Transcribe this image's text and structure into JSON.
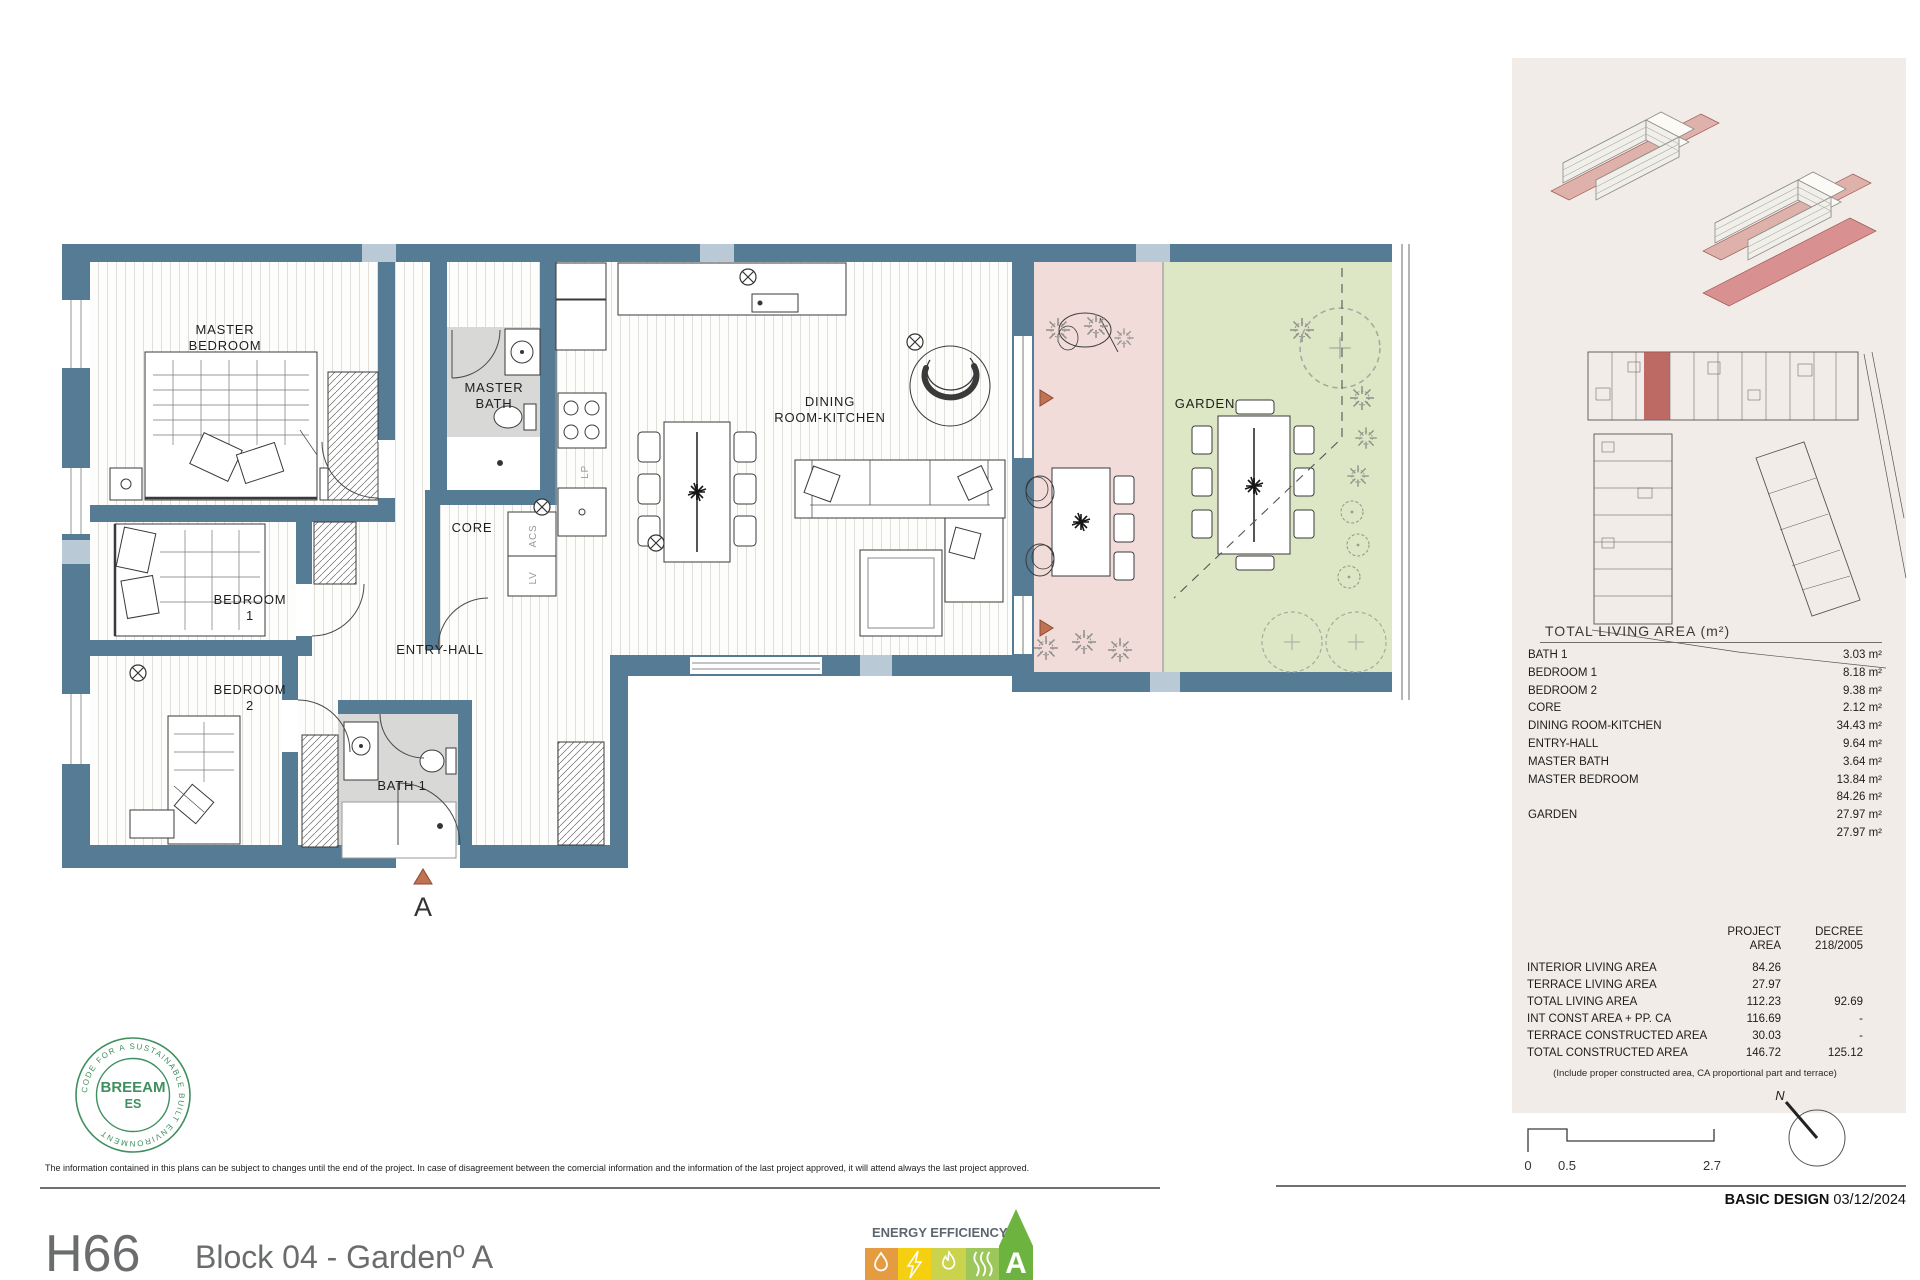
{
  "colors": {
    "wall": "#567b94",
    "wall_light": "#b9cad6",
    "terrace_floor": "#f2dcda",
    "garden_floor": "#dde7c5",
    "bath_floor": "#d8d8d6",
    "panel_background": "#f2ece8",
    "site_highlight_red": "#b4544d",
    "breeam_green": "#3f8f5f",
    "marker_terracotta": "#bf7350",
    "energy_orange": "#e59b40",
    "energy_yellow": "#f5d011",
    "energy_yellow_green": "#cbd34c",
    "energy_light_green": "#9dc65b",
    "energy_a_green": "#6db33f",
    "footer_gray": "#6a6c6e"
  },
  "plan": {
    "labels": {
      "master_bedroom_l1": "MASTER",
      "master_bedroom_l2": "BEDROOM",
      "master_bath_l1": "MASTER",
      "master_bath_l2": "BATH",
      "dining_l1": "DINING",
      "dining_l2": "ROOM-KITCHEN",
      "bedroom1_l1": "BEDROOM",
      "bedroom1_l2": "1",
      "bedroom2_l1": "BEDROOM",
      "bedroom2_l2": "2",
      "entry_hall": "ENTRY-HALL",
      "core": "CORE",
      "bath1": "BATH 1",
      "garden": "GARDEN",
      "lp": "LP",
      "acs": "ACS",
      "lv": "LV",
      "section_marker": "A"
    }
  },
  "panel": {
    "area_table": {
      "title": "TOTAL LIVING AREA (m²)",
      "rows": [
        {
          "label": "BATH 1",
          "value": "3.03 m²"
        },
        {
          "label": "BEDROOM 1",
          "value": "8.18 m²"
        },
        {
          "label": "BEDROOM 2",
          "value": "9.38 m²"
        },
        {
          "label": "CORE",
          "value": "2.12 m²"
        },
        {
          "label": "DINING ROOM-KITCHEN",
          "value": "34.43 m²"
        },
        {
          "label": "ENTRY-HALL",
          "value": "9.64 m²"
        },
        {
          "label": "MASTER BATH",
          "value": "3.64 m²"
        },
        {
          "label": "MASTER BEDROOM",
          "value": "13.84 m²"
        },
        {
          "label": "",
          "value": "84.26 m²"
        },
        {
          "label": "GARDEN",
          "value": "27.97 m²"
        },
        {
          "label": "",
          "value": "27.97 m²"
        }
      ]
    },
    "summary_table": {
      "header_col1_l1": "PROJECT",
      "header_col1_l2": "AREA",
      "header_col2_l1": "DECREE",
      "header_col2_l2": "218/2005",
      "rows": [
        {
          "label": "INTERIOR LIVING AREA",
          "project": "84.26",
          "decree": ""
        },
        {
          "label": "TERRACE LIVING AREA",
          "project": "27.97",
          "decree": ""
        },
        {
          "label": "TOTAL LIVING AREA",
          "project": "112.23",
          "decree": "92.69"
        },
        {
          "label": "INT CONST AREA + PP. CA",
          "project": "116.69",
          "decree": "-"
        },
        {
          "label": "TERRACE CONSTRUCTED AREA",
          "project": "30.03",
          "decree": "-"
        },
        {
          "label": "TOTAL CONSTRUCTED AREA",
          "project": "146.72",
          "decree": "125.12"
        }
      ],
      "footnote": "(Include proper constructed area, CA proportional part and terrace)"
    }
  },
  "scale_bar": {
    "tick0": "0",
    "tick1": "0.5",
    "tick2": "2.7"
  },
  "compass": {
    "north": "N"
  },
  "energy": {
    "title": "ENERGY EFFICIENCY",
    "rating": "A",
    "icons": [
      "water-drop",
      "lightning-bolt",
      "flame",
      "heat-waves"
    ]
  },
  "breeam": {
    "name": "BREEAM",
    "region": "ES",
    "ring_text": "CODE FOR A SUSTAINABLE BUILT ENVIRONMENT"
  },
  "footer": {
    "unit_code": "H66",
    "block_title": "Block 04 -  Gardenº A",
    "stage_label": "BASIC DESIGN",
    "stage_date": "03/12/2024",
    "disclaimer": "The information contained in this plans can be subject to changes until the end of the project. In case of disagreement between the comercial information and the information of the last project approved, it will attend always the last project approved."
  }
}
